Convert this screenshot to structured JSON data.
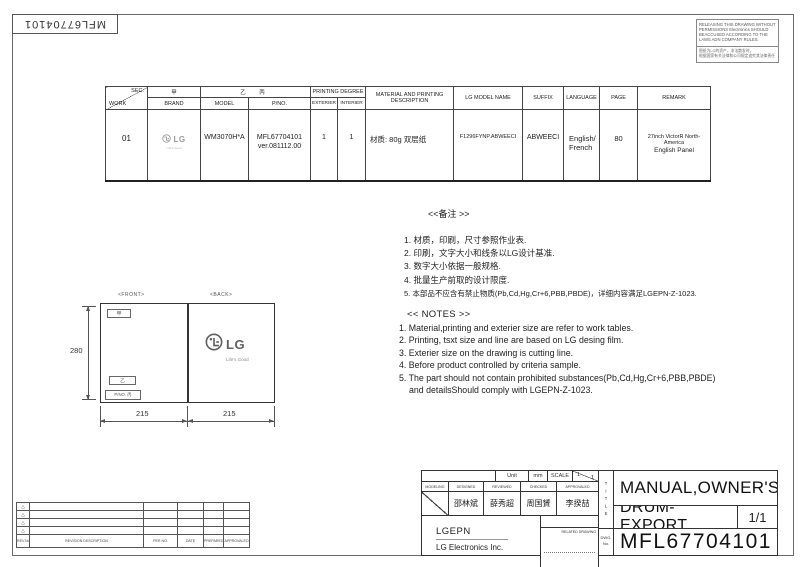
{
  "top_left": {
    "doc_no": "MFL67704101"
  },
  "warning": {
    "english": "RELEASING THIS DRAWING WITHOUT PERMISSIONS Electronics SHOULD BEACCUSED ACCORDING TO THE LAWS ADN COMPANY RULES.",
    "chinese_line1": "图纸为LG的资产，非法散发时，",
    "chinese_line2": "根据国家有关法律和公司规定追究其法律责任"
  },
  "work_table": {
    "headers": {
      "sec": "SEC.",
      "work": "WORK",
      "jia": "甲",
      "brand": "BRAND",
      "yi_bing": "乙 丙",
      "model": "MODEL",
      "pno": "P/NO.",
      "printing_degree": "PRINTING DEGREE",
      "exterier": "EXTERIER",
      "interier": "INTERIER",
      "material": "MATERIAL AND PRINTING DESCRIPTION",
      "lg_model_name": "LG MODEL NAME",
      "suffix": "SUFFIX",
      "language": "LANGUAGE",
      "page": "PAGE",
      "remark": "REMARK"
    },
    "row": {
      "work": "01",
      "brand_logo": "LG",
      "brand_tagline": "Life's Good",
      "model": "WM3070H*A",
      "pno_line1": "MFL67704101",
      "pno_line2": "ver.081112.00",
      "exterier": "1",
      "interier": "1",
      "material": "材质: 80g 双层纸",
      "lg_model_name": "F1296FYNP.ABWEECI",
      "suffix": "ABWEECI",
      "language_line1": "English/",
      "language_line2": "French",
      "page": "80",
      "remark_line1": "27inch VictorR North-America",
      "remark_line2": "English  Panel"
    }
  },
  "notes_cn": {
    "title": "<<备注 >>",
    "items": [
      "1.  材质，印刷，尺寸参照作业表.",
      "2.  印刷，文字大小和线条以LG设计基准.",
      "3.  数字大小依据一般规格.",
      "4.  批量生产前取的设计限度.",
      "5.  本部品不应含有禁止物质(Pb,Cd,Hg,Cr+6,PBB,PBDE)，详细内容满足LGEPN-Z-1023."
    ]
  },
  "notes_en": {
    "title": "<< NOTES >>",
    "items": [
      "1. Material,printing and exterier size are refer to work tables.",
      "2. Printing, tsxt  size and line are based on LG desing film.",
      "3. Exterier size on the drawing is cutting line.",
      "4. Before product controlled by criteria sample.",
      "5. The part should not contain prohibited substances(Pb,Cd,Hg,Cr+6,PBB,PBDE)"
    ],
    "item5_cont": "and detailsShould comply with LGEPN-Z-1023."
  },
  "diagram": {
    "front_label": "<FRONT>",
    "back_label": "<BACK>",
    "jia_box": "甲",
    "yi_box": "乙",
    "pno_box": "P/NO. 丙",
    "dim_height": "280",
    "dim_width_left": "215",
    "dim_width_right": "215",
    "logo_text": "LG",
    "logo_tagline": "Life's Good"
  },
  "revision_table": {
    "footer": [
      "REV.No.",
      "REVISION DESCRIPTION",
      "PER NO.",
      "DATE",
      "PREPARED",
      "APPROVALED"
    ]
  },
  "title_block": {
    "unit_label": "Unit",
    "unit_value": "mm",
    "scale_label": "SCALE",
    "scale_top": "1",
    "scale_bottom": "1",
    "col_labels": [
      "MODELING",
      "DESIGNED",
      "REVIEWED",
      "CHECKED",
      "APPROVALED"
    ],
    "names": [
      "邵林斌",
      "薛秀超",
      "周国贇",
      "李揆喆"
    ],
    "company_short": "LGEPN",
    "company_full": "LG Electronics Inc.",
    "related_drawing": "RELATED DRAWING",
    "title_label": "TITLE",
    "dwg_label_1": "DWG.",
    "dwg_label_2": "No.",
    "title_line1": "MANUAL,OWNER'S",
    "title_line2": "DRUM-EXPORT",
    "sheet": "1/1",
    "dwg_no": "MFL67704101"
  },
  "colors": {
    "line": "#444444",
    "text": "#222222",
    "logo_gray": "#9a9a9a"
  }
}
